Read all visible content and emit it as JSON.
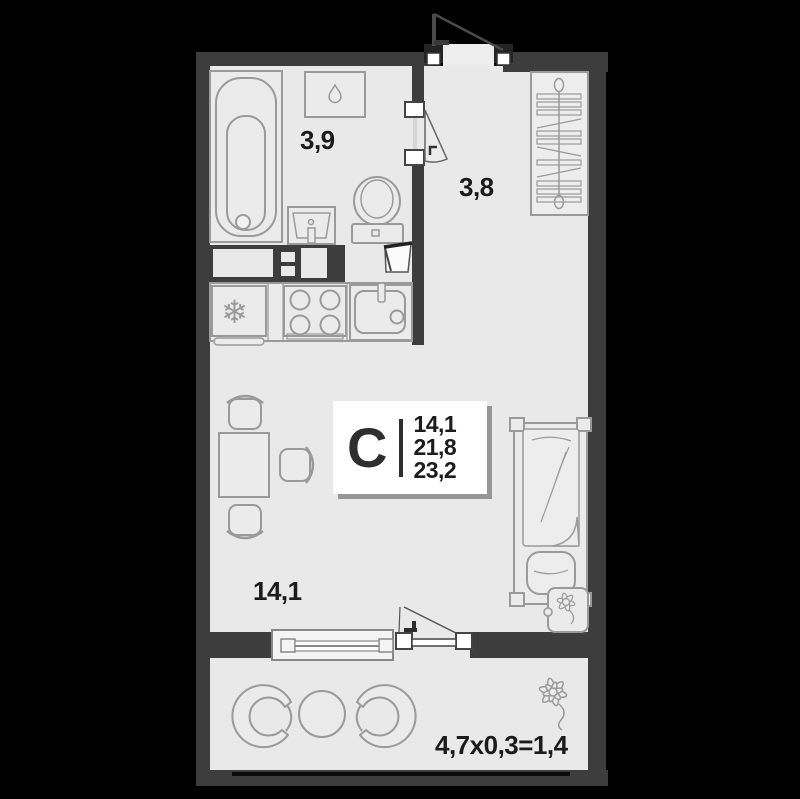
{
  "unit_card": {
    "type_letter": "С",
    "area_values": [
      "14,1",
      "21,8",
      "23,2"
    ]
  },
  "rooms": {
    "bathroom_area": "3,9",
    "hallway_area": "3,8",
    "living_area": "14,1",
    "balcony_formula": "4,7x0,3=1,4"
  },
  "icons": {
    "fridge_snowflake": "❄"
  },
  "colors": {
    "background": "#000000",
    "walls": "#3d3d3d",
    "floor": "#e9e9e9",
    "furniture_line": "#9a9a9a",
    "card_background": "#ffffff",
    "label_text": "#1b1b1b"
  }
}
